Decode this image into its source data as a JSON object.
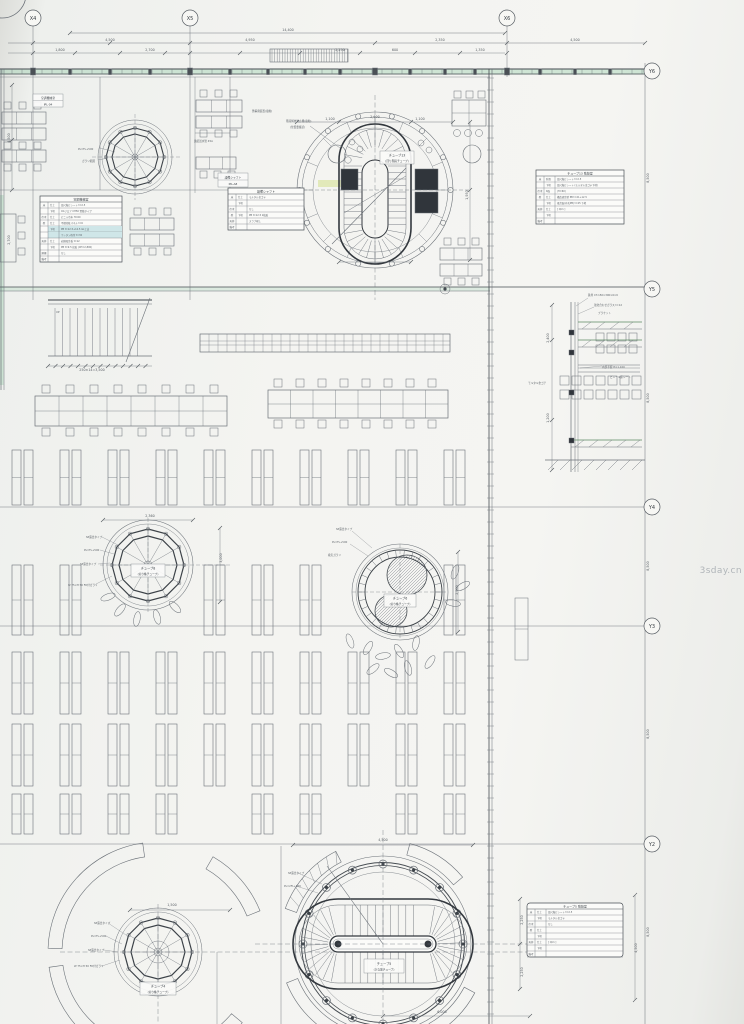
{
  "sheet": {
    "watermark": "3sday.cn"
  },
  "grid": {
    "x": [
      "X4",
      "X5",
      "X6"
    ],
    "y": [
      "Y6",
      "Y5",
      "Y4",
      "Y3",
      "Y2"
    ]
  },
  "room_labels": [
    {
      "title": "空調機械室",
      "code": "IPL-04"
    },
    {
      "title": "設備シャフト",
      "code": "IPL-A8"
    }
  ],
  "tube_labels": [
    {
      "name": "チューブ13",
      "sub": "(回り階段チューブ)"
    },
    {
      "name": "チューブ8",
      "sub": "(切り株チューブ)"
    },
    {
      "name": "チューブ6",
      "sub": "(切り株チューブ)"
    },
    {
      "name": "チューブ4",
      "sub": "(切り株チューブ)"
    },
    {
      "name": "チューブ5",
      "sub": "(ひな壇チューブ)"
    }
  ],
  "finish_tables": [
    {
      "title": "空調機械室",
      "rows": [
        [
          "床",
          "仕上",
          "長尺塩ビシート t=2.5",
          0
        ],
        [
          "",
          "下地",
          "OAフロア CH50 置敷タイプ",
          0
        ],
        [
          "巾木",
          "仕上",
          "ビニル巾木 H=60",
          0
        ],
        [
          "壁",
          "仕上",
          "不燃化粧パネル t=6",
          0
        ],
        [
          "",
          "下地",
          "PB t=12.5+12.5 GL工法",
          1
        ],
        [
          "",
          "",
          "ウレタン吹付 t=30",
          1
        ],
        [
          "天井",
          "仕上",
          "岩綿吸音板 t=12",
          0
        ],
        [
          "",
          "下地",
          "PB t=9.5 捨貼 (CH=2,800)",
          0
        ],
        [
          "廻縁",
          "",
          "なし",
          0
        ],
        [
          "備考",
          "",
          "",
          0
        ]
      ]
    },
    {
      "title": "設備シャフト",
      "rows": [
        [
          "床",
          "仕上",
          "モルタル金ゴテ",
          0
        ],
        [
          "",
          "下地",
          "",
          0
        ],
        [
          "巾木",
          "",
          "なし",
          0
        ],
        [
          "壁",
          "下地",
          "PB t=12.5 2枚貼",
          0
        ],
        [
          "天井",
          "",
          "スラブ現し",
          0
        ],
        [
          "備考",
          "",
          "",
          0
        ]
      ]
    },
    {
      "title": "チューブ13 階段室",
      "rows": [
        [
          "床",
          "防滑",
          "長尺塩ビシート t=2.5",
          0
        ],
        [
          "",
          "下地",
          "長尺塩ビシート (モルタル金ゴテ下地)",
          0
        ],
        [
          "巾木",
          "R面",
          "(H=60)",
          0
        ],
        [
          "壁",
          "仕上",
          "構造遮音壁 PB t=21+12.5",
          0
        ],
        [
          "",
          "下地",
          "吸音面(有孔PB) t=25 下地",
          0
        ],
        [
          "天井",
          "仕上",
          "[ Qim ]",
          0
        ],
        [
          "",
          "下地",
          "",
          0
        ],
        [
          "備考",
          "",
          "",
          0
        ]
      ]
    },
    {
      "title": "チューブ5 階段室",
      "rows": [
        [
          "床",
          "仕上",
          "長尺塩ビシート t=2.5",
          0
        ],
        [
          "",
          "下地",
          "モルタル金ゴテ",
          0
        ],
        [
          "巾木",
          "",
          "なし",
          0
        ],
        [
          "壁",
          "仕上",
          "",
          0
        ],
        [
          "",
          "下地",
          "",
          0
        ],
        [
          "天井",
          "仕上",
          "[ Qim ]",
          0
        ],
        [
          "",
          "下地",
          "",
          0
        ],
        [
          "備考",
          "",
          "",
          0
        ]
      ]
    }
  ],
  "annotations": [
    "SP露出タイプ",
    "PL=FL+500",
    "SP露出タイプ",
    "W 75×H 50 FD付ガラリ",
    "SP露出タイプ",
    "PL=FL+500",
    "吸気ガラリ",
    "SP露出タイプ",
    "PL=FL+500",
    "SP露出タイプ",
    "W 75×H 50 FD付ガラリ",
    "SP露出タイプ",
    "PL=2FL+500",
    "階段解放防止柵(電動)",
    "(位置要確認)",
    "鉄骨 CT-150×300×6×9",
    "強化合わせガラス t=12",
    "ブラケット",
    "内部手摺 H=1,100",
    "ビニール床シート",
    "モルタル金ゴテ",
    "連結送水管 45A",
    "ガラリ範囲",
    "PL=FL+500",
    "懸垂幕装置(電動)",
    "UP"
  ],
  "dimensions": [
    "14,400",
    "4,500",
    "4,950",
    "2,350",
    "4,500",
    "1,800",
    "2,700",
    "2,250",
    "600",
    "1,350",
    "1,100",
    "2,600",
    "1,100",
    "2,360",
    "3,000",
    "1,500",
    "4,500",
    "2,250",
    "2,250",
    "6,000",
    "8,500",
    "8,500",
    "8,500",
    "8,500",
    "8,500",
    "4,500",
    "250×14=3,500",
    "2,400",
    "1,200",
    "1,950",
    "4,500",
    "2,700",
    "2,900"
  ]
}
